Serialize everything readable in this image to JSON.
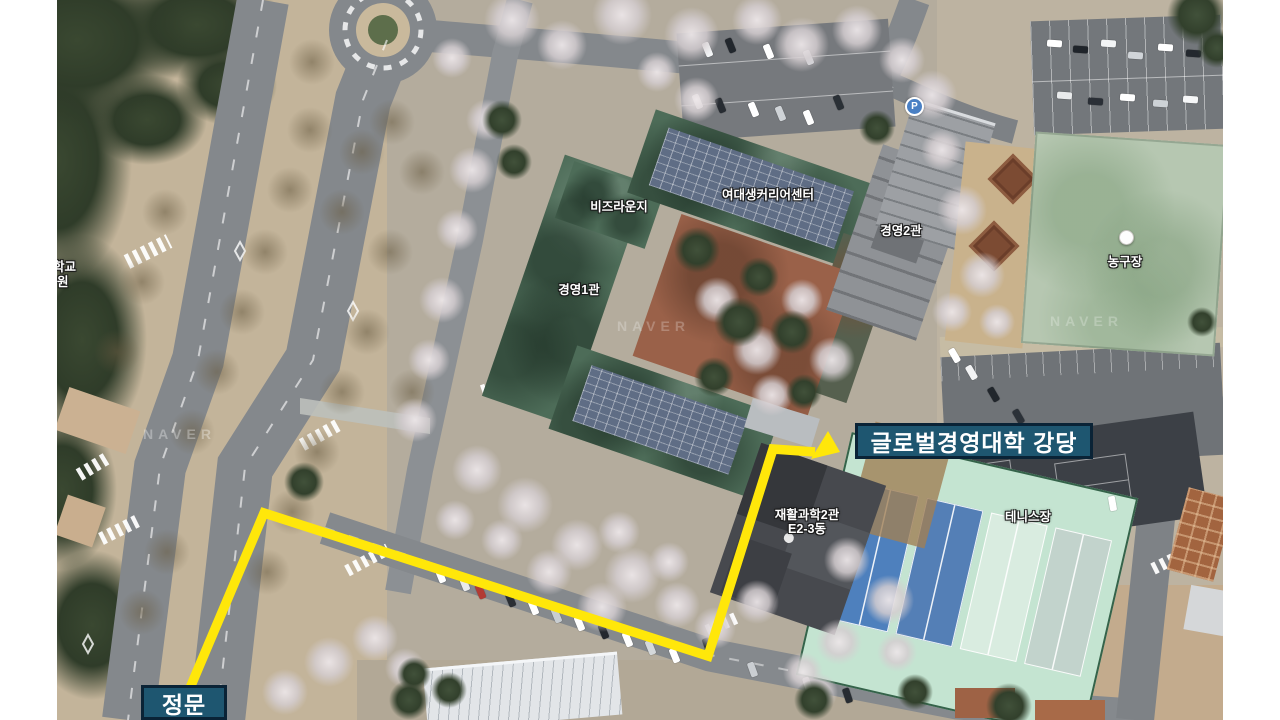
{
  "map": {
    "provider_watermark": "NAVER",
    "route": {
      "color": "#ffe70a",
      "from": "정문",
      "to": "글로벌경영대학 강당"
    },
    "overlay_labels": {
      "destination": "글로벌경영대학 강당",
      "gate": "정문"
    },
    "place_labels": {
      "biz_lounge": "비즈라운지",
      "career_center": "여대생커리어센터",
      "mgmt_hall_1": "경영1관",
      "mgmt_hall_2": "경영2관",
      "basketball_court": "농구장",
      "tennis_court": "테니스장",
      "rehab_science_line1": "재활과학2관",
      "rehab_science_line2": "E2-3동",
      "left_edge_partial_line1": "학교",
      "left_edge_partial_line2": "원"
    },
    "icons": {
      "parking_badge": "P"
    },
    "colors": {
      "route_yellow": "#ffe70a",
      "label_box_fill": "#1e5670",
      "label_box_border": "#0a2336"
    }
  }
}
